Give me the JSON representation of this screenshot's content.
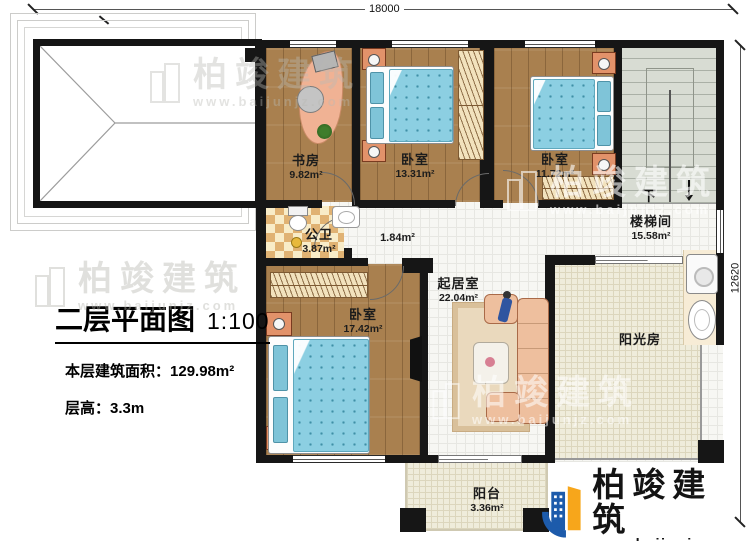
{
  "meta": {
    "plan_title": "二层平面图",
    "scale": "1:100",
    "floor_area_label": "本层建筑面积：",
    "floor_area_value": "129.98m²",
    "floor_height_label": "层高：",
    "floor_height_value": "3.3m"
  },
  "dimensions": {
    "top": "18000",
    "right": "12620"
  },
  "rooms": [
    {
      "id": "study",
      "name": "书房",
      "area": "9.82m²"
    },
    {
      "id": "bedroom1",
      "name": "卧室",
      "area": "13.31m²"
    },
    {
      "id": "bedroom2",
      "name": "卧室",
      "area": "11.72m²"
    },
    {
      "id": "bathroom",
      "name": "公卫",
      "area": "3.87m²"
    },
    {
      "id": "corridor",
      "name": "",
      "area": "1.84m²"
    },
    {
      "id": "stair-hall",
      "name": "楼梯间",
      "area": "15.58m²"
    },
    {
      "id": "living",
      "name": "起居室",
      "area": "22.04m²"
    },
    {
      "id": "bedroom3",
      "name": "卧室",
      "area": "17.42m²"
    },
    {
      "id": "sunroom",
      "name": "阳光房",
      "area": ""
    },
    {
      "id": "balcony",
      "name": "阳台",
      "area": "3.36m²"
    }
  ],
  "stairs": {
    "down_label": "下"
  },
  "brand": {
    "name": "柏竣建筑",
    "website": "www.baijunjz.com",
    "colors": {
      "blue": "#1d5bab",
      "orange": "#f7a61b"
    }
  },
  "watermark": {
    "name": "柏竣建筑",
    "website": "www.baijunjz.com"
  },
  "palette": {
    "wall": "#161616",
    "wood": "#a9804f",
    "bed_blue": "#8ccfe2",
    "checker_tan": "#e0b273",
    "beige_tile": "#efecdb",
    "stair_gray": "#d8dcd3"
  }
}
